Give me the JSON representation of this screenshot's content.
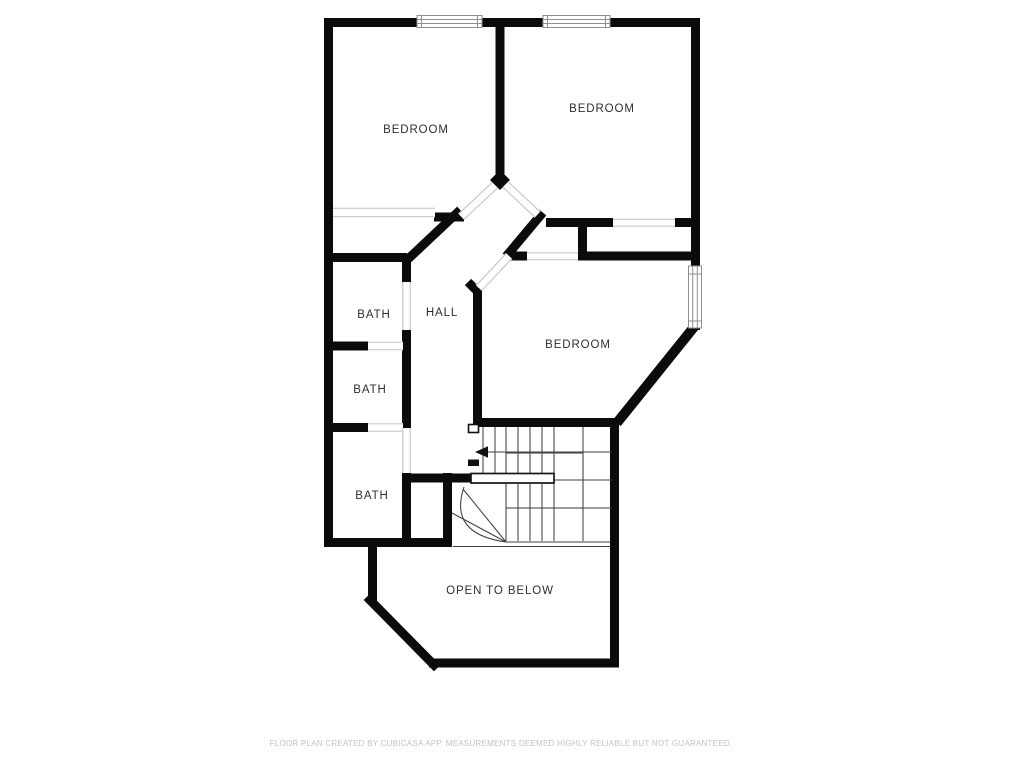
{
  "floor_plan": {
    "creator": "CubiCasa",
    "rooms": [
      {
        "id": "bedroom-left",
        "label": "BEDROOM"
      },
      {
        "id": "bedroom-right",
        "label": "BEDROOM"
      },
      {
        "id": "bath-1",
        "label": "BATH"
      },
      {
        "id": "hall",
        "label": "HALL"
      },
      {
        "id": "bedroom-middle",
        "label": "BEDROOM"
      },
      {
        "id": "bath-2",
        "label": "BATH"
      },
      {
        "id": "bath-3",
        "label": "BATH"
      },
      {
        "id": "open-to-below",
        "label": "OPEN TO BELOW"
      }
    ],
    "stair": {
      "arrow_direction": "left",
      "icon": "stair-direction-arrow"
    },
    "window_count": 3,
    "colors": {
      "background": "#ffffff",
      "wall": "#0b0b0b",
      "opening_line": "#c8c8c8",
      "window_frame": "#8f8f8f",
      "stair_line": "#414141",
      "label_text": "#2e2e2e",
      "footer_text": "#c2c2c2"
    }
  },
  "footer": {
    "disclaimer": "FLOOR PLAN CREATED BY CUBICASA APP. MEASUREMENTS DEEMED HIGHLY RELIABLE BUT NOT GUARANTEED."
  }
}
